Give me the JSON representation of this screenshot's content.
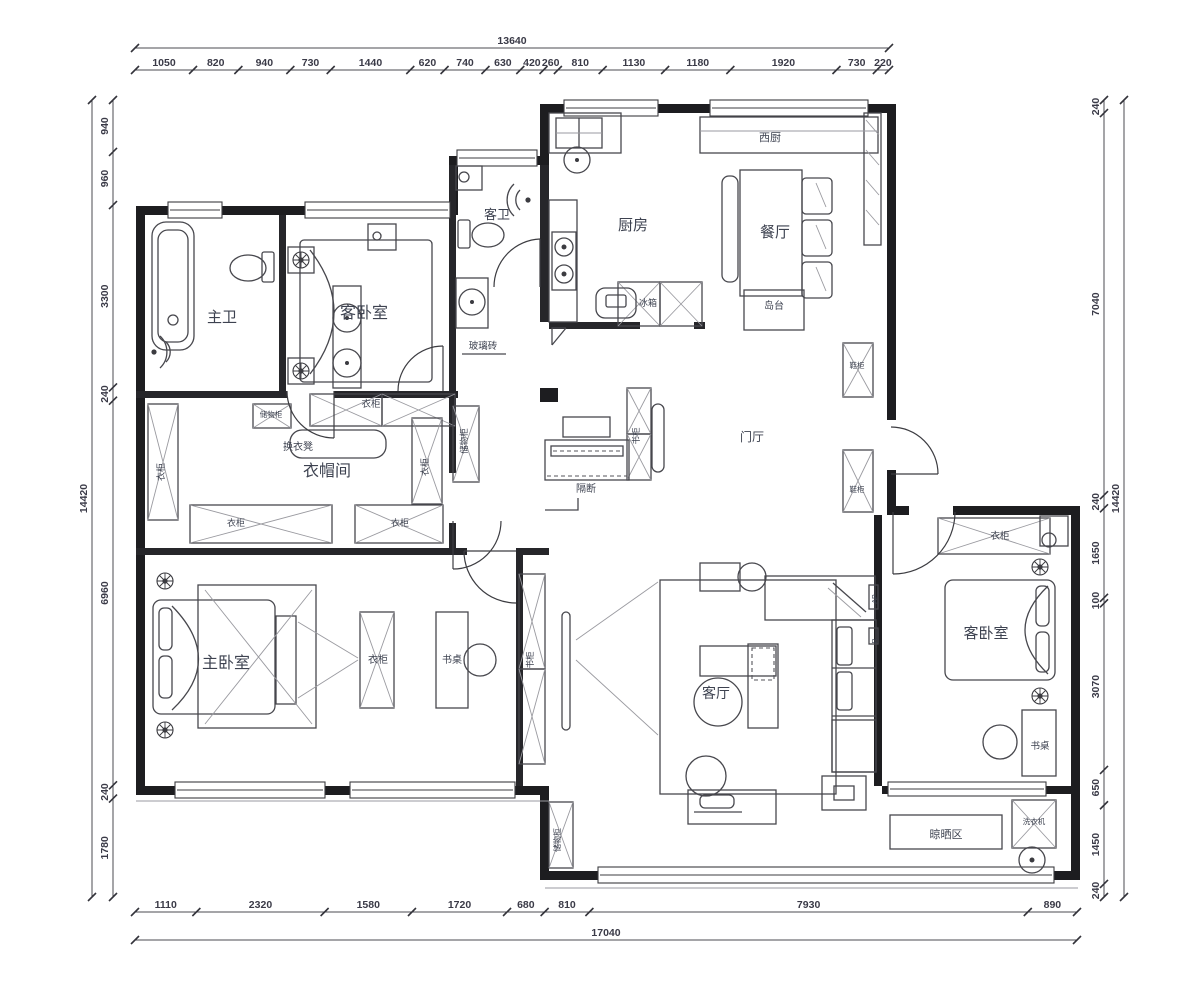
{
  "drawing": {
    "type": "apartment-floor-plan",
    "units": "mm"
  },
  "colors": {
    "wall": "#1d1d20",
    "furniture_line": "#47474d",
    "label_text": "#3d4250",
    "dimension_text": "#3a3a47",
    "background": "#ffffff"
  },
  "dimensions": {
    "top": {
      "total": "13640",
      "segments": [
        "1050",
        "820",
        "940",
        "730",
        "1440",
        "620",
        "740",
        "630",
        "420",
        "260",
        "810",
        "1130",
        "1180",
        "1920",
        "730",
        "220"
      ]
    },
    "bottom": {
      "total": "17040",
      "segments": [
        "1110",
        "2320",
        "1580",
        "1720",
        "680",
        "810",
        "7930",
        "890"
      ]
    },
    "left": {
      "total": "14420",
      "segments": [
        "940",
        "960",
        "3300",
        "240",
        "6960",
        "240",
        "1780"
      ]
    },
    "right": {
      "total": "14420",
      "segments": [
        "240",
        "7040",
        "240",
        "1650",
        "100",
        "3070",
        "650",
        "1450",
        "240"
      ]
    }
  },
  "labels": [
    {
      "id": "room-master-bath",
      "text": "主卫",
      "x": 222,
      "y": 322,
      "s": 15
    },
    {
      "id": "room-guest-bedroom-nw",
      "text": "客卧室",
      "x": 364,
      "y": 318,
      "s": 16
    },
    {
      "id": "room-guest-bath",
      "text": "客卫",
      "x": 497,
      "y": 219,
      "s": 13
    },
    {
      "id": "room-kitchen",
      "text": "厨房",
      "x": 633,
      "y": 230,
      "s": 15
    },
    {
      "id": "label-west-kitchen",
      "text": "西厨",
      "x": 770,
      "y": 141,
      "s": 11
    },
    {
      "id": "room-dining",
      "text": "餐厅",
      "x": 775,
      "y": 237,
      "s": 15
    },
    {
      "id": "label-island",
      "text": "岛台",
      "x": 774,
      "y": 309,
      "s": 10
    },
    {
      "id": "room-foyer",
      "text": "门厅",
      "x": 752,
      "y": 441,
      "s": 12
    },
    {
      "id": "room-cloakroom",
      "text": "衣帽间",
      "x": 327,
      "y": 476,
      "s": 16
    },
    {
      "id": "room-master-bedroom",
      "text": "主卧室",
      "x": 226,
      "y": 668,
      "s": 16
    },
    {
      "id": "room-living",
      "text": "客厅",
      "x": 716,
      "y": 698,
      "s": 14
    },
    {
      "id": "room-guest-bedroom-e",
      "text": "客卧室",
      "x": 986,
      "y": 638,
      "s": 15
    },
    {
      "id": "label-glass-brick",
      "text": "玻璃砖",
      "x": 483,
      "y": 349,
      "s": 9.5
    },
    {
      "id": "label-changing-stool",
      "text": "换衣凳",
      "x": 298,
      "y": 450,
      "s": 10
    },
    {
      "id": "label-storage-small",
      "text": "储物柜",
      "x": 271,
      "y": 417,
      "s": 7.5
    },
    {
      "id": "label-wardrobe-left",
      "text": "衣柜",
      "x": 164,
      "y": 472,
      "s": 9,
      "r": -90
    },
    {
      "id": "label-wardrobe-top",
      "text": "衣柜",
      "x": 371,
      "y": 407,
      "s": 9.5
    },
    {
      "id": "label-wardrobe-right",
      "text": "衣柜",
      "x": 428,
      "y": 467,
      "s": 9,
      "r": -90
    },
    {
      "id": "label-wardrobe-bl",
      "text": "衣柜",
      "x": 236,
      "y": 526,
      "s": 9
    },
    {
      "id": "label-wardrobe-br",
      "text": "衣柜",
      "x": 400,
      "y": 526,
      "s": 9
    },
    {
      "id": "label-storage-tall",
      "text": "储物柜",
      "x": 467,
      "y": 441,
      "s": 8.5,
      "r": -90
    },
    {
      "id": "label-partition",
      "text": "隔断",
      "x": 586,
      "y": 492,
      "s": 10
    },
    {
      "id": "label-bookcase-foyer",
      "text": "书柜",
      "x": 639,
      "y": 436,
      "s": 8.5,
      "r": -90
    },
    {
      "id": "label-shoe-cabinet-1",
      "text": "鞋柜",
      "x": 857,
      "y": 368,
      "s": 7.5
    },
    {
      "id": "label-shoe-cabinet-2",
      "text": "鞋柜",
      "x": 857,
      "y": 492,
      "s": 7.5
    },
    {
      "id": "label-fridge",
      "text": "冰箱",
      "x": 648,
      "y": 306,
      "s": 9
    },
    {
      "id": "label-wardrobe-master",
      "text": "衣柜",
      "x": 378,
      "y": 663,
      "s": 10
    },
    {
      "id": "label-desk-master",
      "text": "书桌",
      "x": 452,
      "y": 663,
      "s": 10
    },
    {
      "id": "label-bookcase-corridor",
      "text": "书柜",
      "x": 533,
      "y": 660,
      "s": 8.5,
      "r": -90
    },
    {
      "id": "label-storage-corridor",
      "text": "储物柜",
      "x": 560,
      "y": 840,
      "s": 8,
      "r": -90
    },
    {
      "id": "label-ap-box",
      "text": "AP",
      "x": 877,
      "y": 599,
      "s": 7,
      "r": -90
    },
    {
      "id": "label-r-box",
      "text": "R",
      "x": 877,
      "y": 641,
      "s": 7,
      "r": -90
    },
    {
      "id": "label-wardrobe-east",
      "text": "衣柜",
      "x": 1000,
      "y": 539,
      "s": 9.5
    },
    {
      "id": "label-desk-east",
      "text": "书桌",
      "x": 1040,
      "y": 749,
      "s": 9.5
    },
    {
      "id": "label-drying-area",
      "text": "晾晒区",
      "x": 946,
      "y": 838,
      "s": 11
    },
    {
      "id": "label-washing-machine",
      "text": "洗衣机",
      "x": 1034,
      "y": 824,
      "s": 7.5
    }
  ]
}
